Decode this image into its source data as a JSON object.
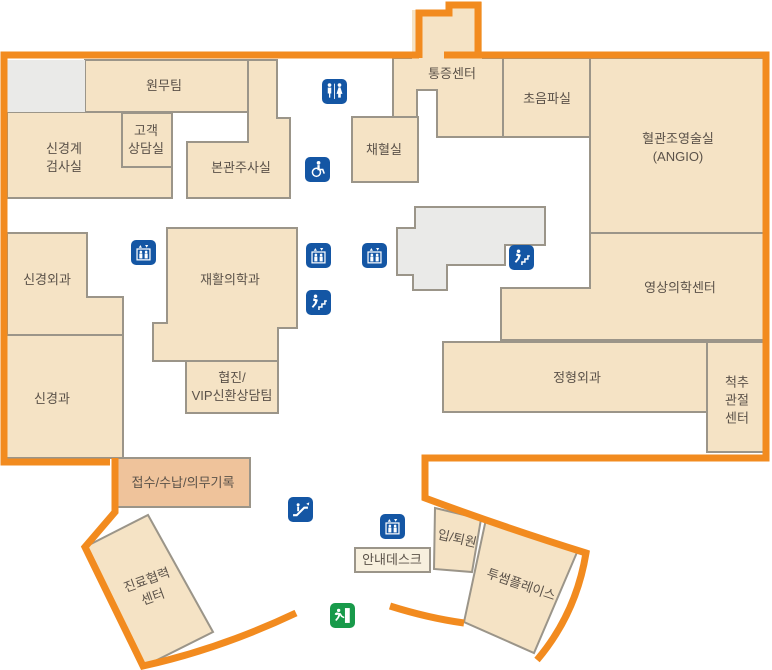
{
  "rooms": {
    "wonmu": {
      "label": "원무팀"
    },
    "singyeonggye": {
      "label": "신경계\n검사실"
    },
    "gogaek": {
      "label": "고객\n상담실"
    },
    "bonkwan": {
      "label": "본관주사실"
    },
    "tongjeung": {
      "label": "통증센터"
    },
    "choeumpa": {
      "label": "초음파실"
    },
    "angio": {
      "label": "혈관조영술실\n(ANGIO)"
    },
    "chaehyeol": {
      "label": "채혈실"
    },
    "singyeongoegwa": {
      "label": "신경외과"
    },
    "jaehwal": {
      "label": "재활의학과"
    },
    "singyeonggwa": {
      "label": "신경과"
    },
    "hyeopjin": {
      "label": "협진/\nVIP신환상담팀"
    },
    "yeongsang": {
      "label": "영상의학센터"
    },
    "jeonghyeong": {
      "label": "정형외과"
    },
    "cheokchu": {
      "label": "척추\n관절\n센터"
    },
    "jeopsu": {
      "label": "접수/수납/의무기록"
    },
    "jinryo": {
      "label": "진료협력\n센터"
    },
    "annae": {
      "label": "안내데스크"
    },
    "iptoewon": {
      "label": "입/퇴원"
    },
    "twosome": {
      "label": "투썸플레이스"
    }
  },
  "icons": {
    "restroom": "restroom-icon",
    "wheelchair": "wheelchair-icon",
    "elevator": "elevator-icon",
    "stairs": "stairs-icon",
    "escalator": "escalator-icon",
    "exit": "emergency-exit-icon"
  },
  "colors": {
    "outline_orange": "#F28B1F",
    "room_fill": "#F5E3C5",
    "reception_fill": "#EFC39B",
    "core_gray": "#EAEAE8",
    "wall_gray": "#9B9589",
    "icon_blue": "#1456A4",
    "exit_green": "#189A4A",
    "label_text": "#5B5249"
  }
}
